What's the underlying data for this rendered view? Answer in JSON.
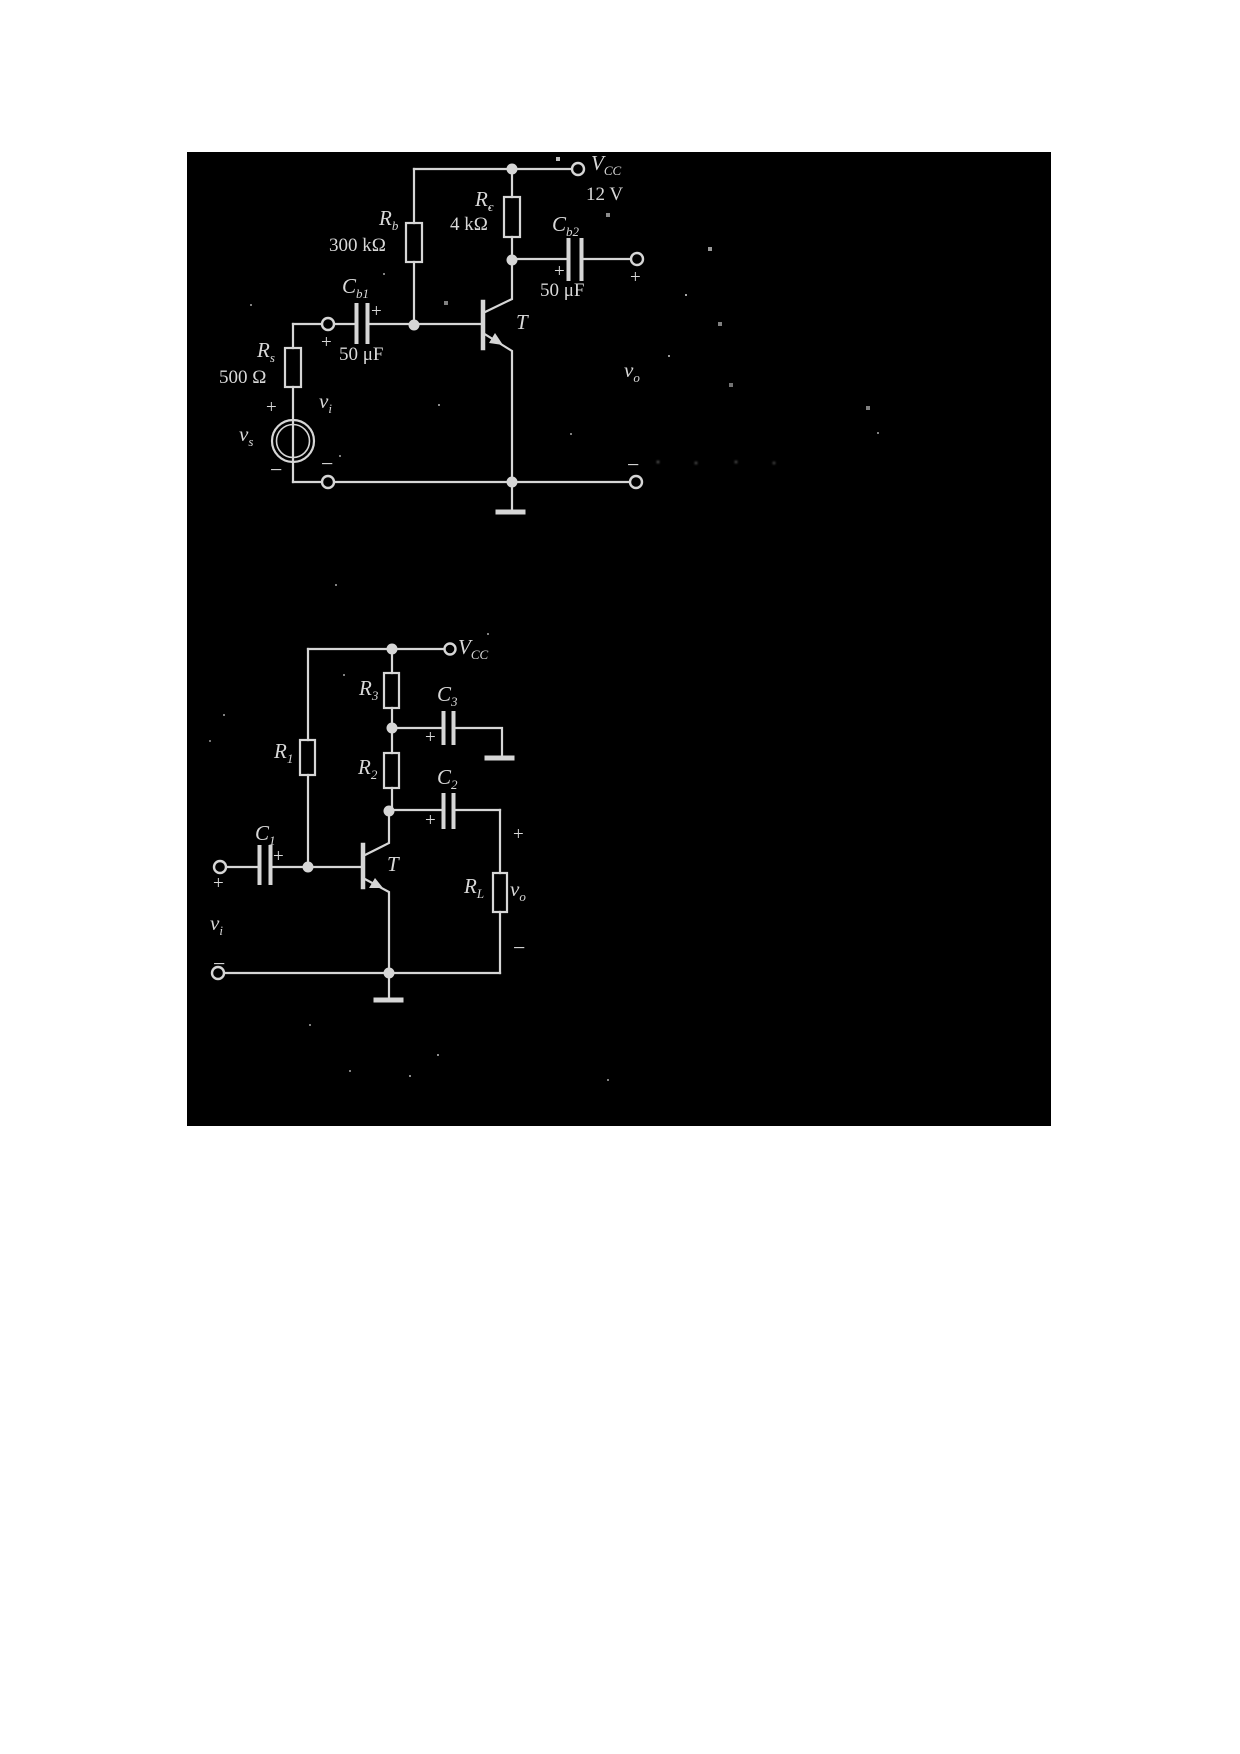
{
  "colors": {
    "paper": "#ffffff",
    "scan_background": "#000000",
    "ink": "#d6d6d6"
  },
  "signs": {
    "plus": "+",
    "minus": "−"
  },
  "circuit1": {
    "vcc": {
      "symbol": "V",
      "subscript": "CC",
      "value": "12 V"
    },
    "rb": {
      "symbol": "R",
      "subscript": "b",
      "value": "300 kΩ"
    },
    "rc": {
      "symbol": "R",
      "subscript": "c",
      "value": "4 kΩ"
    },
    "cb1": {
      "symbol": "C",
      "subscript": "b1",
      "value": "50 μF"
    },
    "cb2": {
      "symbol": "C",
      "subscript": "b2",
      "value": "50 μF"
    },
    "rs": {
      "symbol": "R",
      "subscript": "s",
      "value": "500 Ω"
    },
    "vs": {
      "symbol": "v",
      "subscript": "s"
    },
    "vi": {
      "symbol": "v",
      "subscript": "i"
    },
    "vo": {
      "symbol": "v",
      "subscript": "o"
    },
    "transistor": "T"
  },
  "circuit2": {
    "vcc": {
      "symbol": "V",
      "subscript": "CC"
    },
    "r1": {
      "symbol": "R",
      "subscript": "1"
    },
    "r2": {
      "symbol": "R",
      "subscript": "2"
    },
    "r3": {
      "symbol": "R",
      "subscript": "3"
    },
    "c1": {
      "symbol": "C",
      "subscript": "1"
    },
    "c2": {
      "symbol": "C",
      "subscript": "2"
    },
    "c3": {
      "symbol": "C",
      "subscript": "3"
    },
    "rl": {
      "symbol": "R",
      "subscript": "L"
    },
    "vi": {
      "symbol": "v",
      "subscript": "i"
    },
    "vo": {
      "symbol": "v",
      "subscript": "o"
    },
    "transistor": "T"
  }
}
